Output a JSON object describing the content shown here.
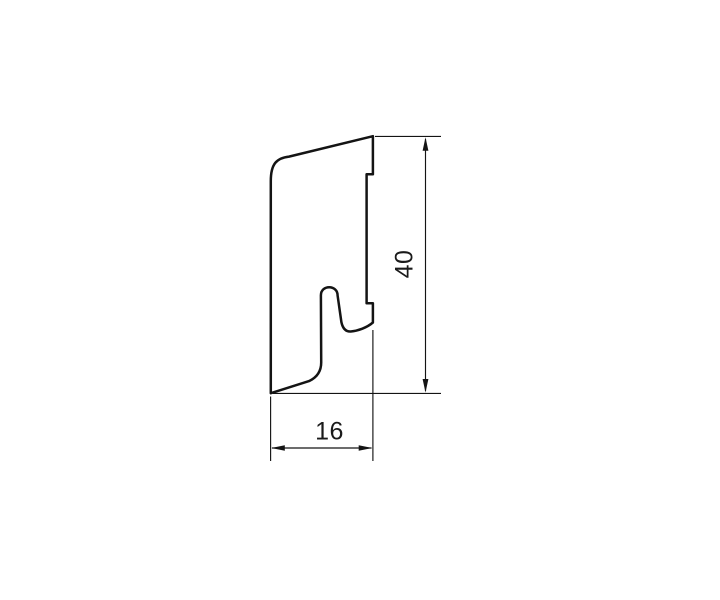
{
  "theme": {
    "background": "#ffffff",
    "line_color": "#141414",
    "text_color": "#1a1a1a"
  },
  "drawing": {
    "kind": "technical cross-section drawing",
    "subject": "skirting-board profile",
    "profile": {
      "outline_path": "M 270.8 393.2 L 270.8 181 C 270.8 164 276.5 158 289 156.6 L 372.9 136.2 L 372.9 174.2 L 366.6 174.2 L 366.6 303.3 L 372.9 303.3 L 372.9 322.5 C 367 327.6 358 330.8 350.8 331.5 C 345.6 331.9 342.8 328.5 341.4 322.2 L 337.6 295.5 C 337.6 284.5 320.9 284.5 320.9 295.3 L 321.2 362.5 C 321.2 371.5 316.5 377.6 309 381.1 L 270.8 393.2 Z"
    },
    "dimensions": {
      "height": {
        "label": "40",
        "value": 40,
        "orientation": "vertical",
        "side": "right"
      },
      "width": {
        "label": "16",
        "value": 16,
        "orientation": "horizontal",
        "side": "bottom"
      }
    }
  }
}
